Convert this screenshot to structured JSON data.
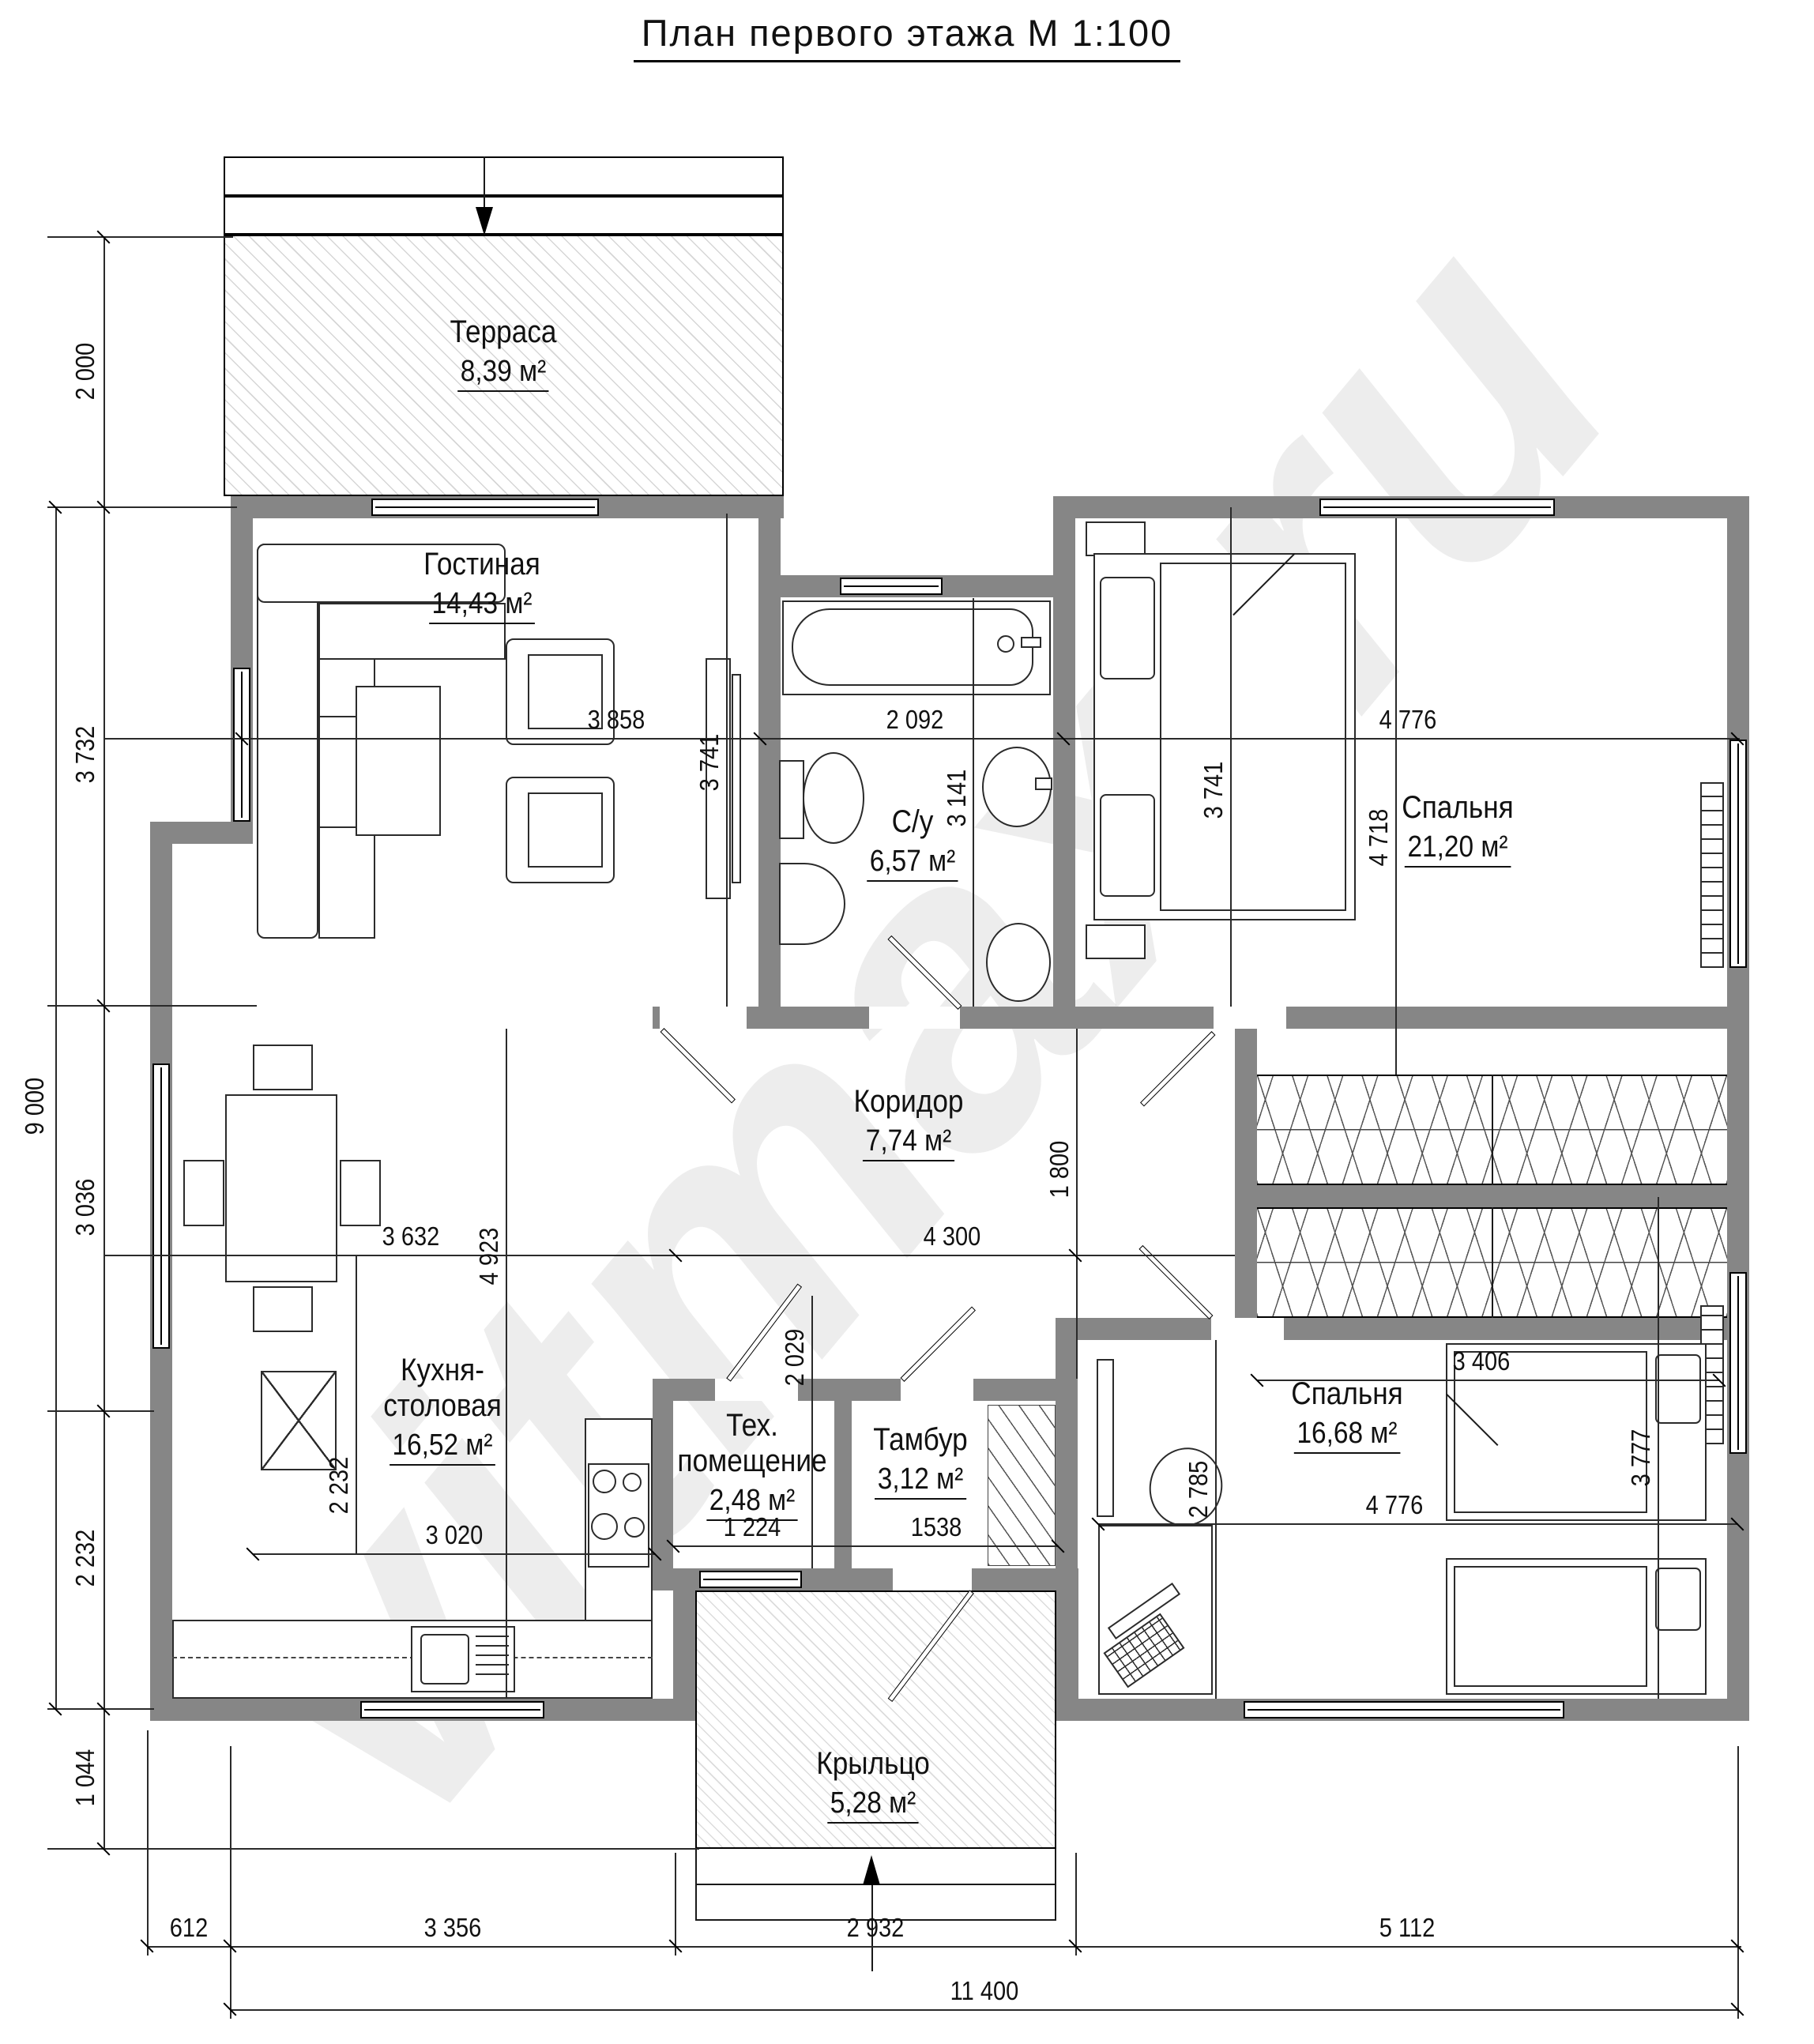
{
  "title": {
    "text": "План первого этажа М 1:100"
  },
  "watermark": {
    "text": "vitmax.ru"
  },
  "colors": {
    "wall": "#868686"
  },
  "rooms": {
    "terrace": {
      "name": "Терраса",
      "area": "8,39 м²"
    },
    "living": {
      "name": "Гостиная",
      "area": "14,43 м²"
    },
    "bathroom": {
      "name": "С/у",
      "area": "6,57 м²"
    },
    "bedroom1": {
      "name": "Спальня",
      "area": "21,20 м²"
    },
    "corridor": {
      "name": "Коридор",
      "area": "7,74 м²"
    },
    "kitchen": {
      "name_line1": "Кухня-",
      "name_line2": "столовая",
      "area": "16,52 м²"
    },
    "tech": {
      "name_line1": "Тех.",
      "name_line2": "помещение",
      "area": "2,48 м²"
    },
    "tambour": {
      "name": "Тамбур",
      "area": "3,12 м²"
    },
    "bedroom2": {
      "name": "Спальня",
      "area": "16,68 м²"
    },
    "porch": {
      "name": "Крыльцо",
      "area": "5,28 м²"
    }
  },
  "dims": {
    "left_2000": "2 000",
    "left_3732": "3 732",
    "left_3036": "3 036",
    "left_2232": "2 232",
    "left_1044": "1 044",
    "left_total": "9 000",
    "bottom_612": "612",
    "bottom_3356": "3 356",
    "bottom_2932": "2 932",
    "bottom_5112": "5 112",
    "bottom_total": "11 400",
    "living_w": "3 858",
    "bath_w": "2 092",
    "bed1_w": "4 776",
    "living_h": "3 741",
    "bath_h": "3 141",
    "bed1_h": "3 741",
    "bed1_d": "4 718",
    "kitchen_w": "3 632",
    "corridor_w": "4 300",
    "corridor_h": "1 800",
    "kitchen_h": "4 923",
    "kitchen_h2": "2 232",
    "kitchen_w2": "3 020",
    "tech_h": "2 029",
    "tech_w": "1 224",
    "tambour_w": "1538",
    "bed2_h": "2 785",
    "bed2_w": "4 776",
    "bed2_d": "3 777",
    "closet_w": "3 406"
  }
}
